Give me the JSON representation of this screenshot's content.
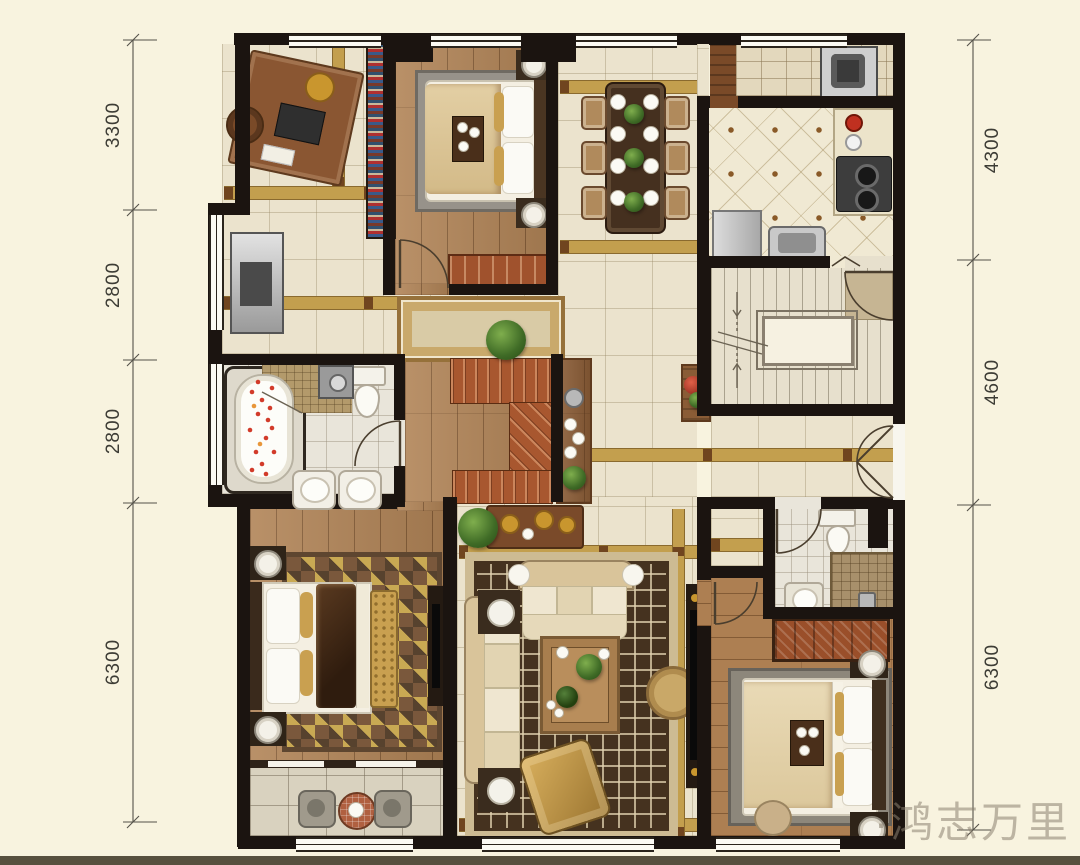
{
  "watermark": {
    "text": "·鸿志万里",
    "color": "#8a8070"
  },
  "dims": {
    "left": [
      {
        "label": "3300"
      },
      {
        "label": "2800"
      },
      {
        "label": "2800"
      },
      {
        "label": "6300"
      }
    ],
    "right": [
      {
        "label": "4300"
      },
      {
        "label": "4600"
      },
      {
        "label": "6300"
      }
    ]
  },
  "palette": {
    "page_background": "#f8f3df",
    "wall": "#1b1410",
    "tile_floor": "#ebe3cd",
    "gold_inlay": "#c39f4e",
    "wood_floor": "#b18457",
    "red_stairs": "#a8572f",
    "living_rug_field": "#45321f",
    "living_rug_border": "#cdbb93",
    "bath_floor": "#e9e5da",
    "stone_balcony": "#d9d2bf",
    "footer_bar": "#57503e"
  }
}
